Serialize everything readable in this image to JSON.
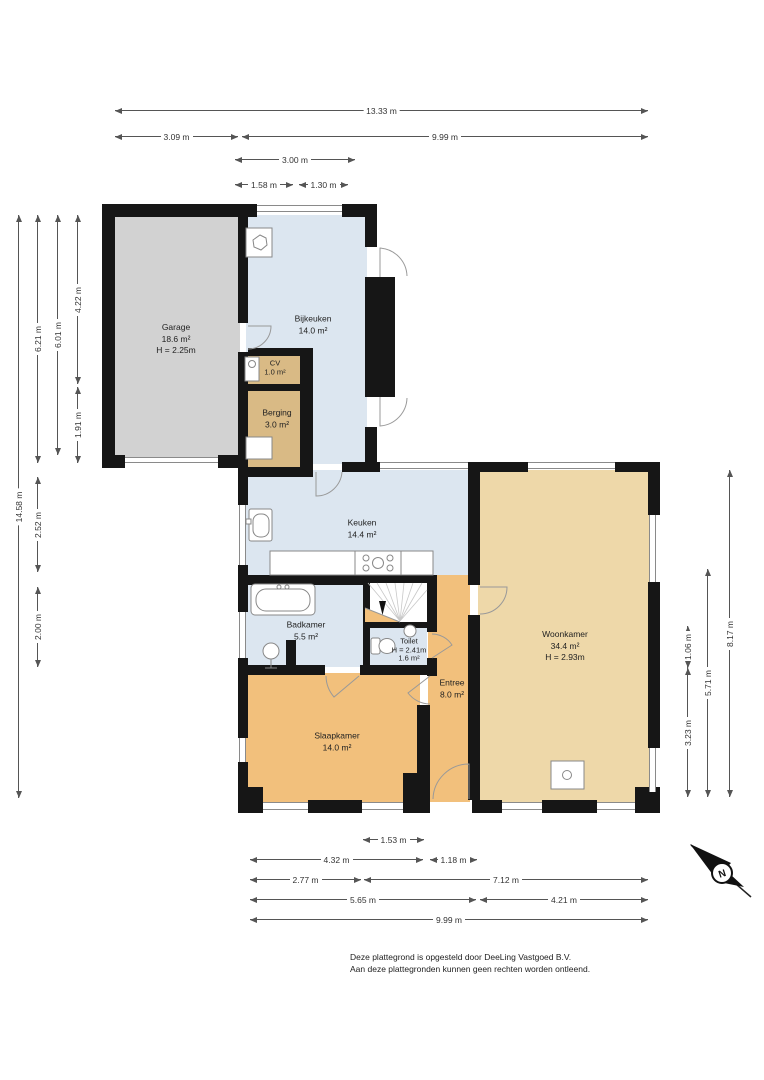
{
  "rooms": {
    "garage": {
      "name": "Garage",
      "area": "18.6 m²",
      "ceiling_height": "H = 2.25m"
    },
    "bijkeuken": {
      "name": "Bijkeuken",
      "area": "14.0 m²"
    },
    "cv": {
      "name": "CV",
      "area": "1.0 m²"
    },
    "berging": {
      "name": "Berging",
      "area": "3.0 m²"
    },
    "keuken": {
      "name": "Keuken",
      "area": "14.4 m²"
    },
    "badkamer": {
      "name": "Badkamer",
      "area": "5.5 m²"
    },
    "toilet": {
      "name": "Toilet",
      "ceiling_height": "H = 2.41m",
      "area": "1.6 m²"
    },
    "entree": {
      "name": "Entree",
      "area": "8.0 m²"
    },
    "slaapkamer": {
      "name": "Slaapkamer",
      "area": "14.0 m²"
    },
    "woonkamer": {
      "name": "Woonkamer",
      "area": "34.4 m²",
      "ceiling_height": "H = 2.93m"
    }
  },
  "dimensions": {
    "top": [
      "13.33 m",
      "3.09 m",
      "9.99 m",
      "3.00 m",
      "1.58 m",
      "1.30 m"
    ],
    "left": [
      "14.58 m",
      "6.21 m",
      "2.52 m",
      "2.00 m",
      "6.01 m",
      "4.22 m",
      "1.91 m"
    ],
    "right": [
      "1.06 m",
      "3.23 m",
      "5.71 m",
      "8.17 m"
    ],
    "bottom": [
      "1.53 m",
      "4.32 m",
      "1.18 m",
      "2.77 m",
      "7.12 m",
      "5.65 m",
      "4.21 m",
      "9.99 m"
    ]
  },
  "compass": {
    "label": "N"
  },
  "footer": {
    "line1": "Deze plattegrond is opgesteld door DeeLing Vastgoed B.V.",
    "line2": "Aan deze plattegronden kunnen geen rechten worden ontleend."
  },
  "colors": {
    "wall": "#161616",
    "room_blue": "#dce6f0",
    "room_gray": "#d2d2d2",
    "room_tan": "#d9ba85",
    "room_orange": "#f2c07c",
    "room_light_orange": "#eed8a9",
    "dim_line": "#555555",
    "text": "#222222"
  }
}
